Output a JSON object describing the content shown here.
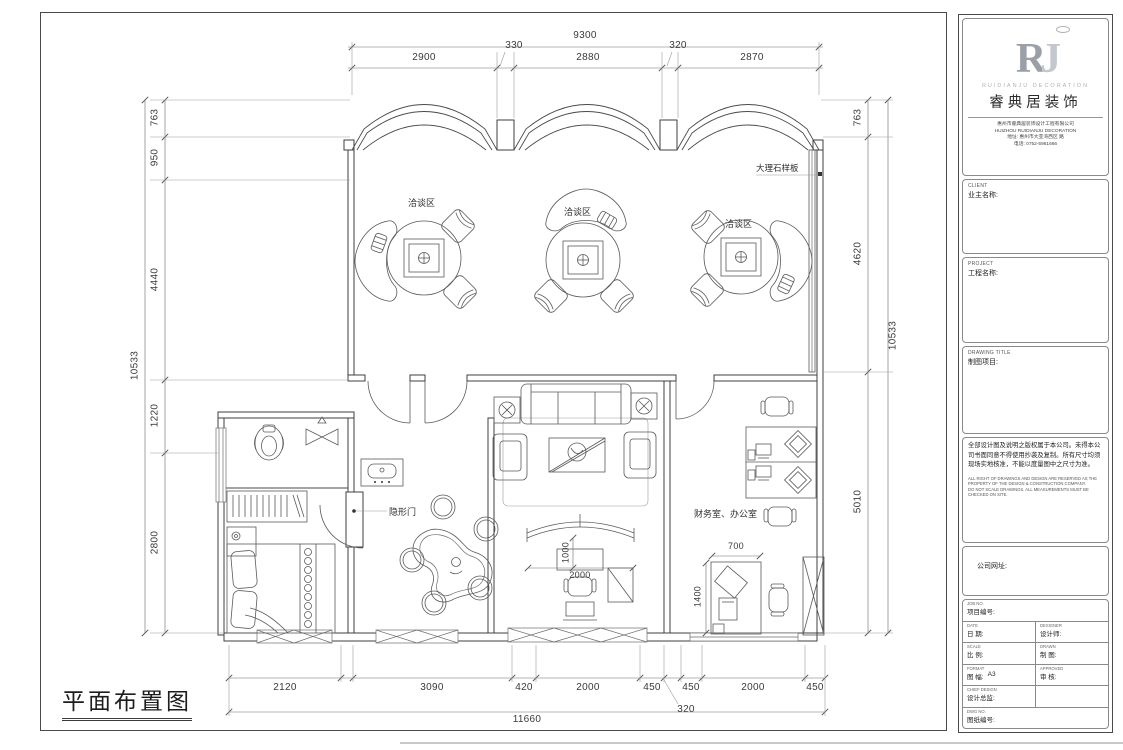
{
  "plan": {
    "title": "平面布置图",
    "labels": {
      "negotiation1": "洽谈区",
      "negotiation2": "洽谈区",
      "negotiation3": "洽谈区",
      "marble_board": "大理石样板",
      "hidden_door": "隐形门",
      "finance_office": "财务室、办公室"
    },
    "dimensions": {
      "top": {
        "overall": "9300",
        "segments": [
          "2900",
          "330",
          "2880",
          "320",
          "2870"
        ]
      },
      "left": {
        "overall": "10533",
        "segments": [
          "763",
          "950",
          "4440",
          "1220",
          "2800"
        ]
      },
      "right": {
        "overall": "10533",
        "segments": [
          "763",
          "4620",
          "5010"
        ]
      },
      "bottom": {
        "overall": "11660",
        "segments": [
          "2120",
          "3090",
          "420",
          "2000",
          "450",
          "450",
          "2000",
          "450"
        ],
        "callout": "320"
      },
      "interior": {
        "arch_depth": "1000",
        "arch_width": "2000",
        "desk_width": "700",
        "desk_depth": "1400"
      }
    }
  },
  "titleblock": {
    "logo_monogram_r": "R",
    "logo_monogram_j": "J",
    "logo_en": "RUIDIANJU DECORATION",
    "logo_cn": "睿典居装饰",
    "company_line1": "惠州市睿典居装饰设计工程有限公司",
    "company_line2": "HUIZHOU RUIDIANJU DECORATION",
    "company_line3": "地址: 惠州市大亚湾西区 路",
    "company_line4": "电话: 0752-5961666",
    "client_en": "CLIENT",
    "client_cn": "业主名称:",
    "project_en": "PROJECT",
    "project_cn": "工程名称:",
    "drawing_title_en": "DRAWING TITLE",
    "drawing_title_cn": "制图项目:",
    "notice_cn": "全部设计图及说明之版权属于本公司。未得本公司书面同意不得使用抄袭及复制。所有尺寸均须现场实地核准，不能以度量图中之尺寸为准。",
    "notice_en1": "ALL RIGHT OF DRAWINGS AND DESIGN ARE RESERVED AS THE PROPERTY OF THE DESIGN & CONSTRUCTION COMPANY.",
    "notice_en2": "DO NOT SCALE DRAWINGS. ALL MEASUREMENTS MUST BE CHECKED ON SITE.",
    "website_label": "公司网址:",
    "fields": {
      "job_no_en": "JOB NO.",
      "job_no_cn": "项目编号:",
      "date_en": "DATE",
      "date_cn": "日 期:",
      "designer_en": "DESIGNER",
      "designer_cn": "设计师:",
      "scale_en": "SCALE",
      "scale_cn": "比 例:",
      "drawn_en": "DRAWN",
      "drawn_cn": "制 图:",
      "format_en": "FORMAT",
      "format_cn": "图 幅:",
      "format_value": "A3",
      "approved_en": "APPROVED",
      "approved_cn": "审 核:",
      "chief_en": "CHIEF DESIGN",
      "chief_cn": "设计总监:",
      "dwg_no_en": "DWG NO.",
      "dwg_no_cn": "图纸编号:"
    }
  }
}
